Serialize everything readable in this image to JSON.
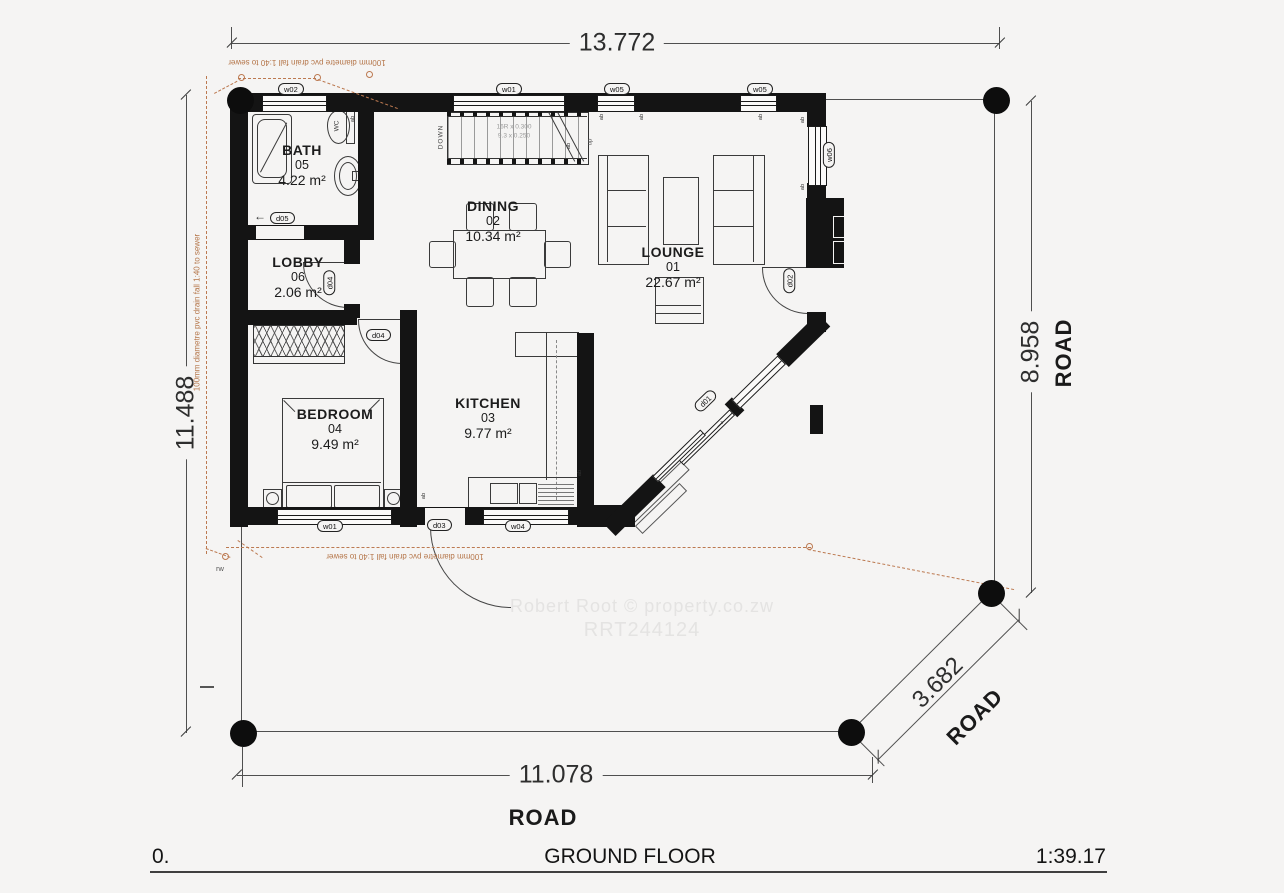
{
  "title_block": {
    "sheet_no": "0.",
    "title": "GROUND FLOOR",
    "scale": "1:39.17"
  },
  "watermark": {
    "line1": "Robert Root  ©  property.co.zw",
    "line2": "RRT244124"
  },
  "dimensions": {
    "top": "13.772",
    "left": "11.488",
    "right": "8.958",
    "bottom": "11.078",
    "diagonal": "3.682"
  },
  "road_labels": {
    "right": "ROAD",
    "bottom": "ROAD",
    "diagonal": "ROAD"
  },
  "rooms": {
    "bath": {
      "name": "BATH",
      "number": "05",
      "area": "4.22 m²"
    },
    "lobby": {
      "name": "LOBBY",
      "number": "06",
      "area": "2.06 m²"
    },
    "dining": {
      "name": "DINING",
      "number": "02",
      "area": "10.34 m²"
    },
    "lounge": {
      "name": "LOUNGE",
      "number": "01",
      "area": "22.67 m²"
    },
    "bedroom": {
      "name": "BEDROOM",
      "number": "04",
      "area": "9.49 m²"
    },
    "kitchen": {
      "name": "KITCHEN",
      "number": "03",
      "area": "9.77 m²"
    }
  },
  "openings": {
    "w02": "w02",
    "w01_top": "w01",
    "w05_a": "w05",
    "w05_b": "w05",
    "w06": "w06",
    "d02": "d02",
    "d01": "d01",
    "d05": "d05",
    "d04_lobby": "d04",
    "d04_bedroom": "d04",
    "w01_bottom": "w01",
    "d03": "d03",
    "w04": "w04"
  },
  "stairs": {
    "down": "DOWN",
    "up": "up",
    "note1": "16R x 0.300",
    "note2": "9.3 x 0.250"
  },
  "annotations": {
    "drain_top": "100mm diametre pvc drain fall 1:40 to sewer",
    "drain_left": "100mm diametre pvc drain fall 1:40 to sewer",
    "drain_bottom": "100mm diametre pvc drain fall 1:40 to sewer",
    "wc": "WC",
    "ab": "ab",
    "rw": "rw",
    "arrow_left": "←",
    "arrow_slide": "→"
  },
  "colors": {
    "wall": "#141414",
    "line": "#555555",
    "drain": "#bc7950",
    "watermark": "#e4e3e2",
    "text": "#1c1c1c"
  }
}
